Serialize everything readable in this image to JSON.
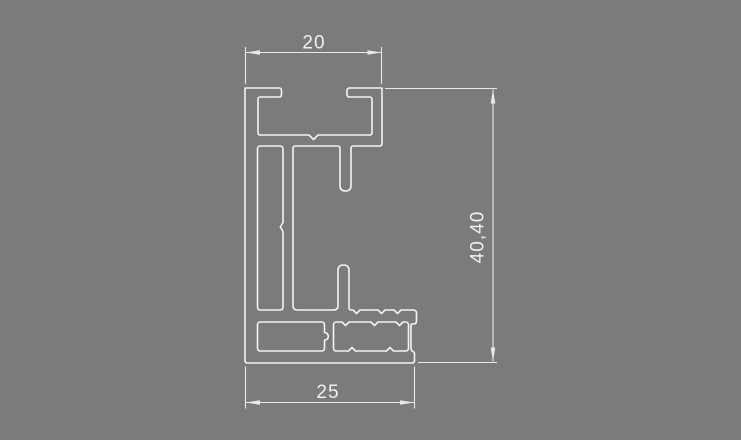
{
  "drawing": {
    "title": "aluminium-profile-cross-section",
    "dimensions": {
      "top_width": "20",
      "bottom_width": "25",
      "height": "40,40"
    }
  },
  "colors": {
    "background": "#7b7b7b",
    "outline": "#f3f3f3",
    "dimension": "#e9e9e9",
    "text": "#f0f0f0"
  }
}
